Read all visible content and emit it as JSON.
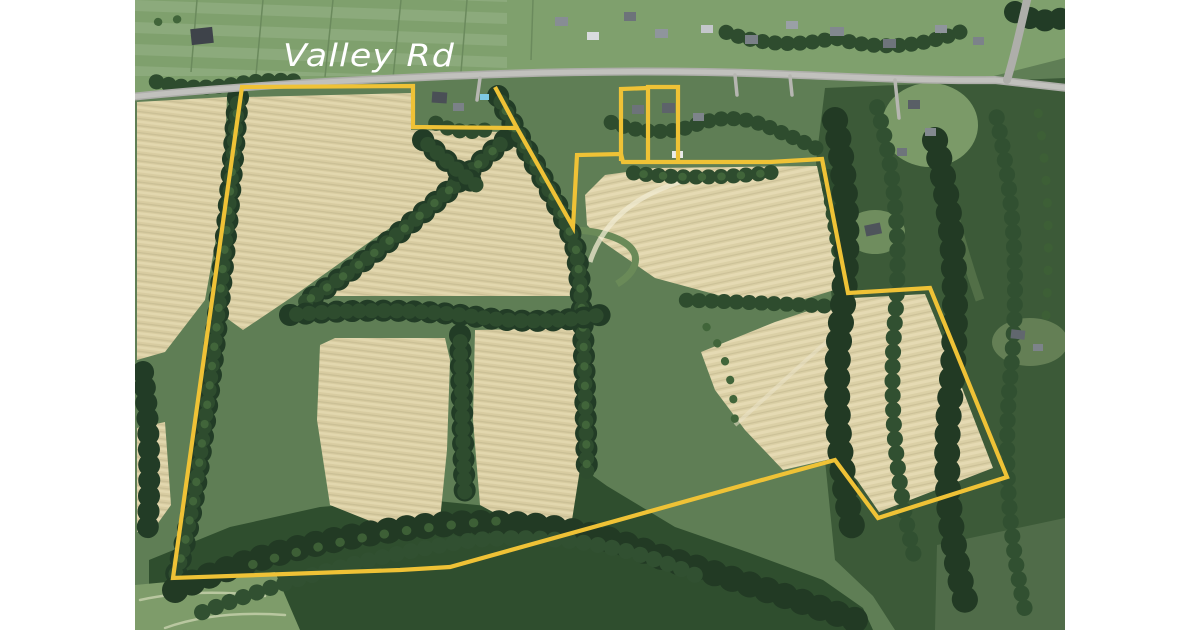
{
  "page": {
    "background_color": "#ffffff"
  },
  "map": {
    "kind": "satellite-aerial-photo",
    "road_label": "Valley Rd",
    "road_label_color": "#ffffff",
    "boundary_color": "#efc236",
    "field_color": "#d8cca1",
    "forest_color": "#2f4e2e",
    "lawn_color": "#7fa06d",
    "road_color": "#b3b3af"
  }
}
